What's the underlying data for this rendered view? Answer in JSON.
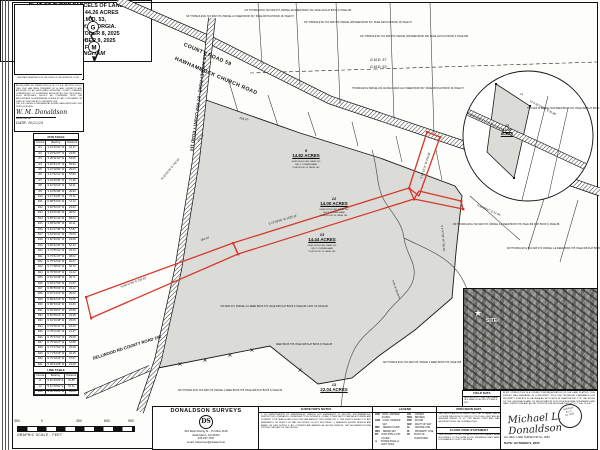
{
  "colors": {
    "red": "#d6392b",
    "parcel_gray": "#dbdbd8",
    "line": "#1a1a1a"
  },
  "title_block": {
    "line1": "PLAT OF THREE PARCELS OF LAND",
    "line2": "BEING A TOTAL OF 44.26 ACRES",
    "line3": "LOCATED IN G.M.D. 53,",
    "line4": "EMANUEL COUNTY, GEORGIA.",
    "line5": "SURVEY DATE: OCTOBER 8, 2025",
    "line6": "PLAT DATE: OCTOBER 9, 2025",
    "line7": "SURVEYED FOR:",
    "line8": "BILLY CUNNINGHAM"
  },
  "clerk_box": {
    "caption": "THIS SPACE RESERVED FOR THE CLERK OF THE SUPERIOR COURT"
  },
  "left_cert": {
    "body": "AS REQUIRED BY SUBSECTION (d) OF O.C.G.A. SECTION 15-6-67, THIS PLAT HAS BEEN PREPARED BY A LAND SURVEYOR AND APPROVED BY ALL APPLICABLE MUNICIPAL, COUNTY PLANNING COMMISSIONS OR GOVERNING AUTHORITIES FOR RECORDING. SUCH APPROVALS SHOULD BE CONFIRMED WITH THE APPROPRIATE GOVERNMENTAL BODIES BY ANY PURCHASER OR USER OF THIS PLAT AS TO INTENDED USE.\nTHE FOLLOWING GOVERNMENTAL BODIES HAVE APPROVED THIS PLAT FOR FILING:",
    "sig": "W. M. Donaldson",
    "sig_label": "REGISTRATION",
    "date_line": "DATE:  10/22/25"
  },
  "run_table": {
    "title": "RUN TABLE",
    "headers": [
      "Course",
      "Bearing",
      "Distance"
    ],
    "rows": [
      [
        "R1",
        "S 24°10'31\" W",
        "42.17"
      ],
      [
        "R2",
        "S 26°22'07\" W",
        "43.56"
      ],
      [
        "R3",
        "S 28°11'52\" W",
        "53.05"
      ],
      [
        "R4",
        "S 30°54'47\" W",
        "59.84"
      ],
      [
        "R5",
        "S 34°18'09\" W",
        "29.03"
      ],
      [
        "R6",
        "S 37°02'21\" W",
        "57.84"
      ],
      [
        "R7",
        "S 39°45'56\" W",
        "71.48"
      ],
      [
        "R8",
        "S 42°10'14\" W",
        "63.21"
      ],
      [
        "R9",
        "S 44°52'08\" W",
        "39.96"
      ],
      [
        "R10",
        "S 47°33'25\" W",
        "70.11"
      ],
      [
        "R11",
        "N 88°51'04\" W",
        "74.12"
      ],
      [
        "R12",
        "S 52°40'31\" W",
        "29.83"
      ],
      [
        "R13",
        "S 54°06'46\" W",
        "38.52"
      ],
      [
        "R14",
        "S 56°41'12\" W",
        "88.63"
      ],
      [
        "R15",
        "S 58°02'55\" W",
        "40.21"
      ],
      [
        "R16",
        "S 61°17'38\" W",
        "57.87"
      ],
      [
        "R17",
        "S 63°49'41\" W",
        "76.63"
      ],
      [
        "R18",
        "S 66°30'02\" W",
        "43.08"
      ],
      [
        "R19",
        "S 68°12'26\" W",
        "60.44"
      ],
      [
        "R20",
        "S 70°55'13\" W",
        "45.44"
      ],
      [
        "R21",
        "S 73°21'47\" W",
        "38.02"
      ],
      [
        "R22",
        "N 75°42'19\" W",
        "40.67"
      ],
      [
        "R23",
        "N 77°08'52\" W",
        "56.79"
      ],
      [
        "R24",
        "N 79°36'15\" W",
        "41.22"
      ],
      [
        "R25",
        "N 81°02'38\" W",
        "36.71"
      ],
      [
        "R26",
        "N 83°27'54\" W",
        "41.87"
      ],
      [
        "R27",
        "N 85°55'09\" W",
        "45.22"
      ],
      [
        "R28",
        "N 87°14'31\" W",
        "35.02"
      ],
      [
        "R29",
        "N 89°42'16\" W",
        "54.68"
      ],
      [
        "R30",
        "N 86°03'44\" W",
        "31.83"
      ],
      [
        "R31",
        "N 84°29'57\" W",
        "25.89"
      ],
      [
        "R32",
        "N 82°55'23\" W",
        "43.28"
      ],
      [
        "R33",
        "N 81°20'48\" W",
        "25.05"
      ],
      [
        "R34",
        "N 79°46'11\" W",
        "34.43"
      ],
      [
        "R35",
        "N 78°11'36\" W",
        "21.47"
      ],
      [
        "R36",
        "N 76°37'02\" W",
        "35.08"
      ],
      [
        "R37",
        "N 75°02'27\" W",
        "44.88"
      ],
      [
        "R38",
        "N 73°27'52\" W",
        "25.08"
      ],
      [
        "R39",
        "N 71°53'18\" W",
        "34.45"
      ],
      [
        "R40",
        "N 70°18'43\" W",
        "37.67"
      ],
      [
        "R41",
        "N 68°44'08\" W",
        "24.08"
      ],
      [
        "R42",
        "N 67°09'34\" W",
        "33.42"
      ],
      [
        "R43",
        "N 65°34'59\" W",
        "41.62"
      ],
      [
        "R44",
        "N 64°00'24\" W",
        "22.78"
      ],
      [
        "R45",
        "N 62°25'50\" W",
        "33.02"
      ],
      [
        "R46",
        "N 60°51'15\" W",
        "43.63"
      ]
    ]
  },
  "line_table": {
    "title": "LINE TABLE",
    "headers": [
      "Course",
      "Bearing",
      "Distance"
    ],
    "rows": [
      [
        "L1",
        "S 62°20'29\" E",
        "91.85"
      ],
      [
        "L2",
        "S 67°40'54\" E",
        "97.41"
      ]
    ]
  },
  "scale": {
    "labels": [
      "300",
      "0",
      "300",
      "600",
      "900"
    ],
    "caption": "GRAPHIC SCALE  -  FEET"
  },
  "firm": {
    "name": "DONALDSON SURVEYS",
    "logo": "DS",
    "address1": "616 West Moring St. - P.O.Box 1128",
    "address2": "Swainsboro, GA 30401",
    "phone": "478-237-7337",
    "email": "email: wdsurveys@pineland.net"
  },
  "notes": {
    "title": "SURVEYOR'S NOTES",
    "body": "1. NO INVESTIGATION OR INDEPENDENT SEARCH FOR EASEMENTS OF RECORD, ENCUMBRANCES, RESTRICTIVE COVENANTS, OWNERSHIP TITLE EVIDENCE, OR ANY OTHER FACTS THAT AN ACCURATE AND CURRENT TITLE SEARCH MAY DISCLOSE WAS MADE BY THIS SURVEYOR.  2. THIS PLAT IS SUBJECT TO ANY EASEMENTS OR RIGHTS OF WAY, RECORDED OR NOT RECORDED.  3. BEARINGS SHOWN HEREON ARE BASED ON GRID NORTH.  4. ALL CORNERS ARE MARKED AS SHOWN HEREON. THE DECLARATION EVEN THOUGH THE DATE OF THE SHOWN."
  },
  "legend": {
    "title": "LEGEND",
    "items_left": [
      [
        "CMF",
        "CONC. MARKER FOUND"
      ],
      [
        "CMS",
        "CONC. MARKER SET"
      ],
      [
        "RBF",
        "REBAR FOUND"
      ],
      [
        "RBS",
        "REBAR SET"
      ],
      [
        "IPF",
        "IRON PIPE or PIN FOUND"
      ],
      [
        "⊙",
        "POWER POLE w/ LIGHT POLE"
      ]
    ],
    "items_right": [
      [
        "O/S",
        "OFFSET"
      ],
      [
        "BKN",
        "BROKEN"
      ],
      [
        "FND",
        "FOUND"
      ],
      [
        "R/W",
        "RIGHT OF WAY"
      ],
      [
        "CL",
        "CENTER LINE"
      ],
      [
        "PL",
        "PROPERTY LINE"
      ],
      [
        "PC",
        "POINT OF CURVATURE"
      ]
    ],
    "samples": "—x—x— FENCE   — — — POWER LINE"
  },
  "field_data": {
    "title": "FIELD DATA",
    "body": "FIELD WORK BY TOTAL STATION AND GPS. DATA COLLECTED OCTOBER 8, 2025."
  },
  "precision": {
    "title": "PRECISION DATA",
    "body": "THE FIELD DATA UPON WHICH THIS PLAT IS BASED HAS A CLOSURE PRECISION OF ONE FOOT IN 15,000+ FEET AND AN ANGULAR ERROR OF 02\" PER ANGLE POINT AND WAS ADJUSTED USING THE COMPASS RULE."
  },
  "flood": {
    "title": "FLOOD ZONE STATEMENT",
    "body": "THIS PROPERTY IS NOT LOCATED IN A FLOOD HAZARD AREA ACCORDING TO THE FEMA FLOOD INSURANCE RATE MAPS FOR EMANUEL COUNTY, GEORGIA."
  },
  "right_cert": {
    "body": "IN MY OPINION THIS IS A CORRECT REPRESENTATION OF THE LAND PLATTED. THIS SURVEY WAS PREPARED IN CONFORMITY WITH THE TECHNICAL STANDARDS FOR PROPERTY SURVEYS IN GEORGIA AS SET FORTH IN CHAPTER 180-7 OF THE RULES OF THE GEORGIA BOARD OF REGISTRATION FOR PROFESSIONAL ENGINEERS AND LAND SURVEYORS AND AS SET FORTH IN THE GEORGIA PLAT ACT O.C.G.A. 15-6-67.",
    "sig": "Michael L. Donaldson",
    "seal": "GEORGIA\nR.L.S.\nNo. 2693",
    "reg": "GA. REG. LAND SURVEYOR  No. 2693",
    "date": "DATE:   OCTOBER 9, 2025"
  },
  "map": {
    "road59_line1": "COUNTY ROAD 59",
    "road59_line2": "HAWHAMMOCK CHURCH ROAD",
    "oldwadley": "OLD WADLEY ROAD - 80' R/W\nCOUNTY ROAD 114",
    "dellwood": "DELLWOOD RD\nCOUNTY ROAD 192",
    "gmd_top": "G.M.D. 57",
    "gmd_bottom": "G.M.D. 53",
    "inset_road": "HAWHAMMOCK CHURCH ROAD",
    "site": "SITE",
    "parcels": [
      {
        "num": "9",
        "acres": "14.82 ACRES",
        "sub": "TAX MAP 073, PARCEL 9\nDEED BOOK 480, PAGE 314\nBILLY CUNNINGHAM\nPLAT BOOK 24, PAGE 184"
      },
      {
        "num": "12",
        "acres": "14.00 ACRES",
        "sub": "TAX MAP 073, PARCEL 12\nDEED BOOK 480, PAGE 314\nBILLY CUNNINGHAM\nPLAT BOOK 24, PAGE 184"
      },
      {
        "num": "13",
        "acres": "14.44 ACRES",
        "sub": "TAX MAP 073, PARCEL 13\nDEED BOOK 480, PAGE 314\nBILLY CUNNINGHAM\nPLAT BOOK 24, PAGE 184"
      }
    ],
    "inset_parcel": {
      "num": "12",
      "acres": "14.00\nACRES"
    },
    "remaining": {
      "num": "13",
      "acres": "22.04 ACRES",
      "sub": "(REMAINING PARCEL 13)"
    },
    "bearings": [
      "S 73°02'56\" W   1023.14'",
      "N 68°41'39\" E   233.42'",
      "N 22°52'26\" E   743.33'",
      "S 19°19'11\" W   376.94'",
      "S 4°47'35\" W   750.34'",
      "164.10'",
      "254.75'",
      "293.47'",
      "L1",
      "L2  S 62°20'29\" E  91.85'",
      "S 64°08'47\" E   57.04'",
      "RUN OF BRANCH"
    ],
    "adjoiners": [
      "N/F THOMAS ETAL\nTAX MAP 073, PARCEL 2-C\nDEED BOOK 547, PAGE 308\nPLAT BOOK 18, PAGE 57",
      "N/F THOMAS ETAL\nTAX MAP 073, PARCEL 204\nDEED BOOK 312, PAGE 91\nPLAT BOOK 6, PAGE 250",
      "N/F THOMAS ETAL\nTAX MAP 073, PARCEL 205\nDEED BOOK 547, PAGE 308\nPLAT BOOK 18, PAGE 57",
      "N/F THOMAS ETAL\nTAX MAP 073, PARCEL 206\nDEED BOOK 480, PAGE 122\nPLAT BOOK 9, PAGE 188",
      "THOMAS ETAL PARCEL 204\nJACKIE DUKES LILLY\nDEED BOOK 547, PAGE 308\nPLAT BOOK 18, PAGE 57",
      "N/F THOMAS ETAL\nTAX MAP 073, PARCEL 2-D\nDEED BOOK 575, PAGE 308\nPLAT BOOK 8, PAGE 88",
      "N/F THOMAS ETAL\nTAX MAP 073, PARCEL 2-E\nDEED BOOK 575, PAGE 308\nPLAT BOOK 8, PAGE 88",
      "TAX MAP 073, PARCEL 2-C\nDEED BOOK 575, PAGE 308\nPLAT BOOK 8, PAGE 88\nG.M.D. 53, PAGE 98",
      "DEED BOOK 575, PAGE 308\nPLAT BOOK 8, PAGE 88",
      "N/F THOMAS ETAL\nTAX MAP 073, PARCEL 2\nDEED BOOK 575, PAGE 308\nPLAT BOOK 8, PAGE 88",
      "N/F THOMAS ETAL\nTAX MAP 073, PARCEL 3\nDEED BOOK 575, PAGE 308",
      "THIS MAP IS PARCEL MAP\nDEED BOOK 547, PAGE 308\nPLAT BOOK 18, PAGE 57"
    ]
  }
}
